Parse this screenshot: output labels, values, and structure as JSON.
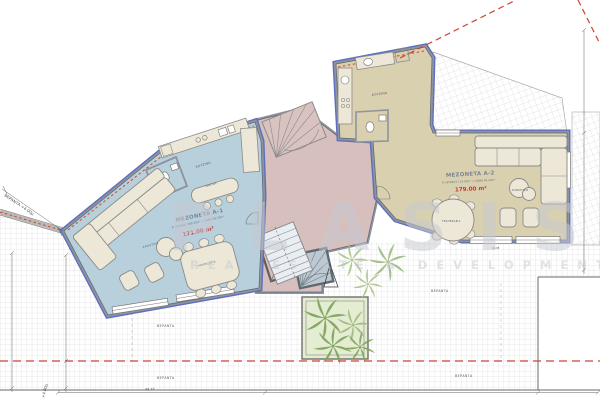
{
  "watermark": {
    "line1": "PLASIS",
    "line2": "REAL ESTATE & DEVELOPMENT"
  },
  "units": {
    "a1": {
      "name": "MEZONETA A-1",
      "breakdown": "Α' ΟΡΟΦΟΣ 105.50m² + ΔΩΜΑ 65.50m²",
      "total_area": "171.00 m²"
    },
    "a2": {
      "name": "MEZONETA A-2",
      "breakdown": "Α' ΟΡΟΦΟΣ 114.00m² + ΔΩΜΑ 65.00m²",
      "total_area": "179.00 m²"
    }
  },
  "rooms": {
    "kitchen": "ΚΟΥΖΙΝΑ",
    "island": "ΝΗΣΙΔΑ",
    "dining": "ΤΡΑΠΕΖΑΡΙΑ",
    "living": "ΚΑΘΙΣΤΙΚΟ",
    "terrace": "ΒΕΡΑΝΤΑ"
  },
  "annotations": {
    "terrace_elevation": "ΒΕΡΑΝΤΑ +4.00μ",
    "elevation": "+4.00μ",
    "dim_bottom": "34.77",
    "dim_wall": "18.95"
  },
  "colors": {
    "unit_a1_floor": "#b7d0dc",
    "unit_a2_floor": "#d9d0b0",
    "core_floor": "#d6bfbc",
    "exterior_wall_accent": "#5e6ec0",
    "boundary_red": "#cc4433",
    "area_text_red": "#c23b34",
    "palm_green": "#7da25b",
    "planter_fill": "#e4ecd2"
  }
}
